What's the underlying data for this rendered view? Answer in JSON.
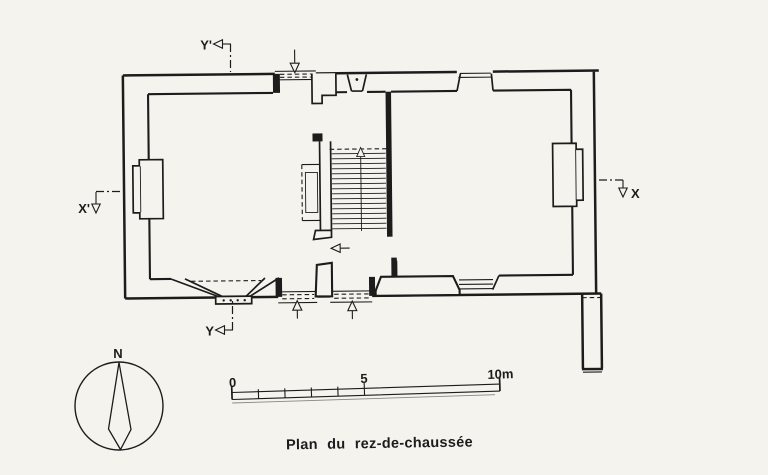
{
  "drawing": {
    "title": "Plan du rez-de-chaussée",
    "compass": {
      "north": "N"
    },
    "scale_bar": {
      "zero": "0",
      "five": "5",
      "ten": "10m"
    },
    "sections": {
      "y_top": "Y'",
      "y_bottom": "Y",
      "x_left": "X'",
      "x_right": "X"
    },
    "colors": {
      "ink": "#1c1c1c",
      "paper": "#f5f3ee"
    }
  }
}
